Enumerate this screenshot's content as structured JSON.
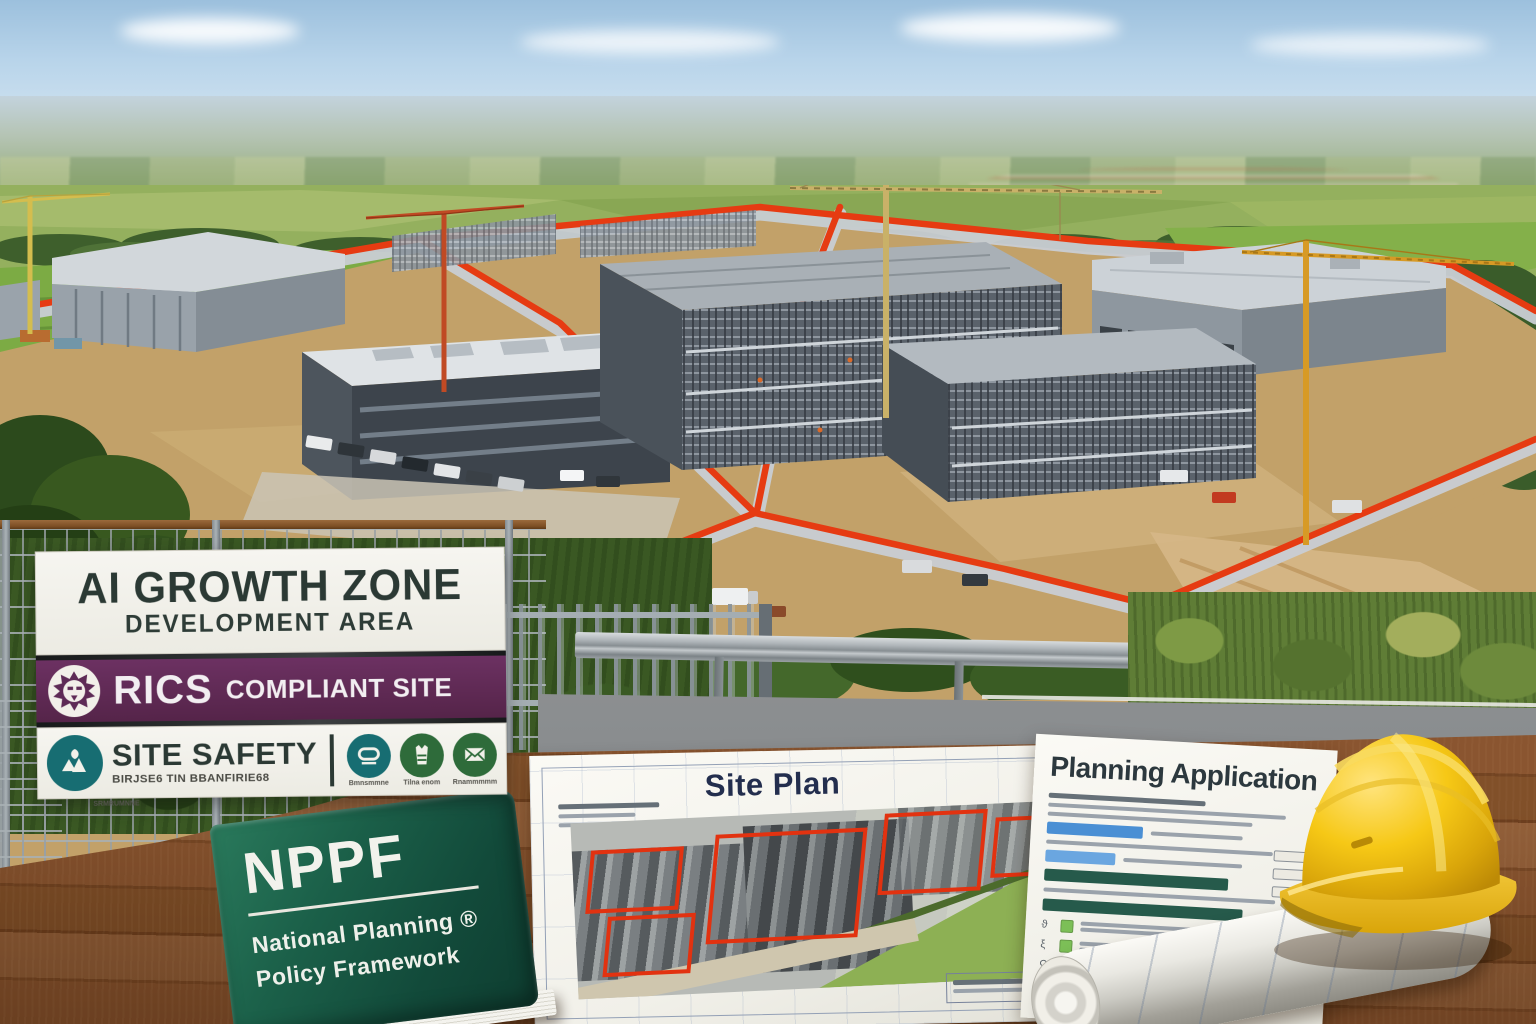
{
  "colors": {
    "boundary_red": "#e63b12",
    "sign_purple": "#5e2a56",
    "sign_ink": "#2b3934",
    "teal_badge": "#176d72",
    "green_badge": "#2e6b3a",
    "book_green": "#1b5a43",
    "hat_yellow": "#f2c412",
    "status_blue": "#4a8fd4",
    "status_green": "#7cbf57",
    "status_dark_green": "#265a4b",
    "status_red": "#d95449"
  },
  "signboard": {
    "title": "AI GROWTH ZONE",
    "subtitle": "DEVELOPMENT AREA",
    "rics_bold": "RICS",
    "rics_label": "COMPLIANT SITE",
    "safety_title": "SITE SAFETY",
    "safety_subtext": "BIRJSE6 TIN BBANFIRIE68",
    "safety_captions": [
      "SRMRUMNNE",
      "Bmnsmmne",
      "Tilna enom",
      "Rnammmmm"
    ]
  },
  "book": {
    "title": "NPPF",
    "line1": "National Planning ®",
    "line2": "Policy Framework"
  },
  "site_plan": {
    "title": "Site Plan"
  },
  "planning_application": {
    "title": "Planning Application"
  }
}
